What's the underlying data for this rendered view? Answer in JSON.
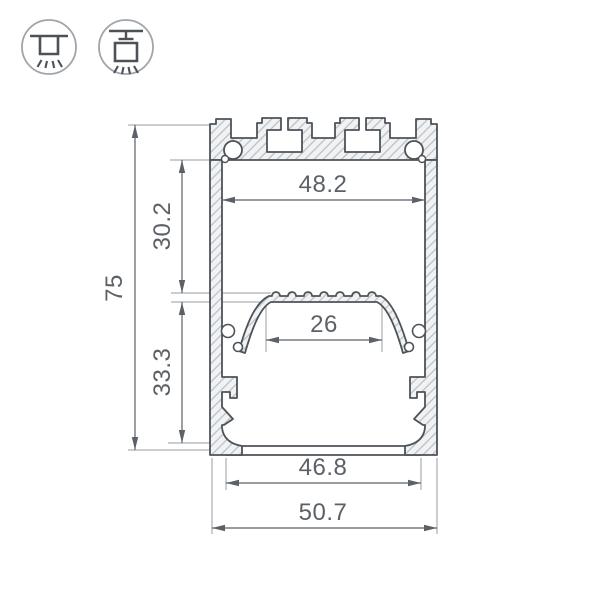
{
  "drawing": {
    "title_semantic": "aluminium-led-profile-cross-section",
    "dimensions": {
      "total_height": "75",
      "upper_chamber_height": "30.2",
      "lower_chamber_height": "33.3",
      "top_inner_width": "48.2",
      "shelf_width": "26",
      "bottom_inner_width": "46.8",
      "total_width": "50.7"
    },
    "colors": {
      "outline": "#4c5359",
      "dimension_lines": "#5b6167",
      "extension_lines": "#979da3",
      "hatch_line": "#b4b9be",
      "hatch_background": "#f0f2f3",
      "icon_ring": "#a0a5ab"
    }
  },
  "icons": {
    "surface_mount": "surface-mount-icon",
    "pendant_mount": "pendant-mount-icon"
  }
}
